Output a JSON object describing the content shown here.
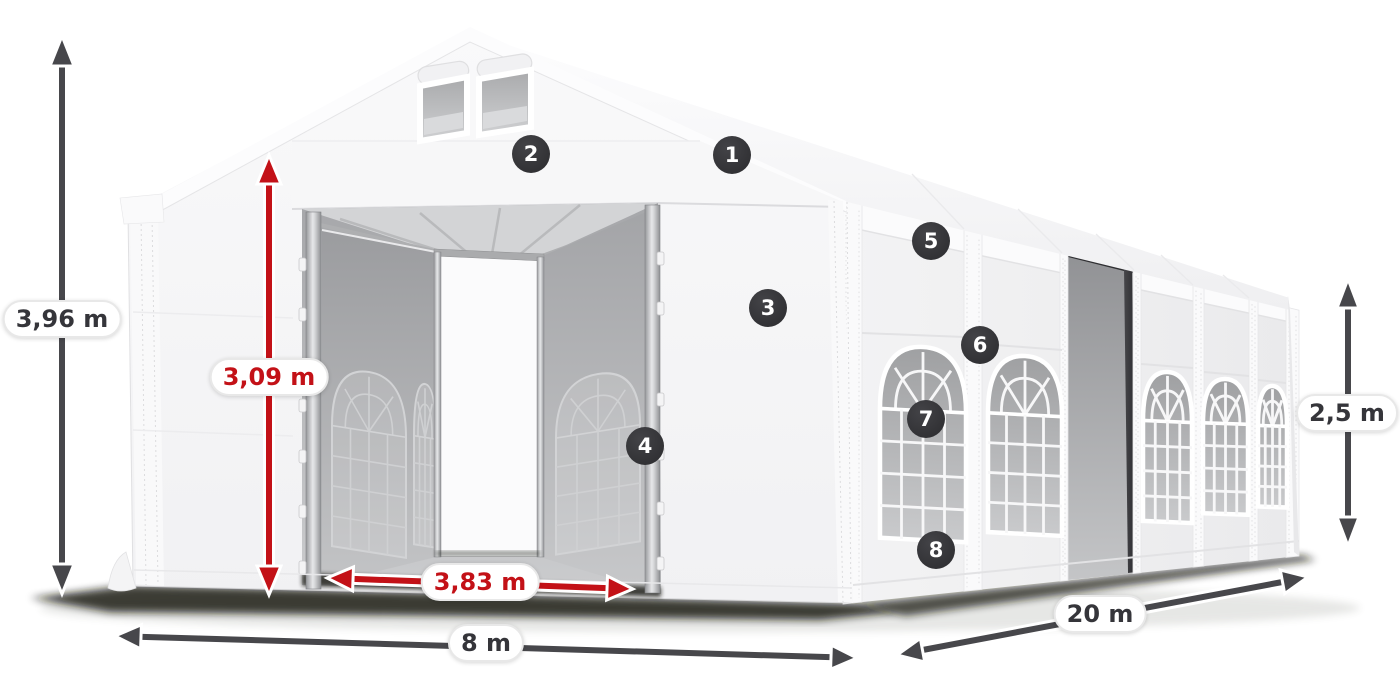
{
  "dimensions": {
    "total_height": {
      "label": "3,96 m"
    },
    "entrance_height": {
      "label": "3,09 m"
    },
    "entrance_width": {
      "label": "3,83 m"
    },
    "width": {
      "label": "8 m"
    },
    "length": {
      "label": "20 m"
    },
    "side_height": {
      "label": "2,5 m"
    }
  },
  "callouts": [
    {
      "number": "1"
    },
    {
      "number": "2"
    },
    {
      "number": "3"
    },
    {
      "number": "4"
    },
    {
      "number": "5"
    },
    {
      "number": "6"
    },
    {
      "number": "7"
    },
    {
      "number": "8"
    }
  ],
  "colors": {
    "arrow_dark": "#47474b",
    "arrow_red": "#c31117",
    "label_dark": "#35353a",
    "label_red": "#c31117",
    "badge_bg": "#313134",
    "badge_text": "#ffffff",
    "pill_bg": "#ffffff",
    "pill_border": "#e8e8e8",
    "shadow": "#14170f"
  }
}
